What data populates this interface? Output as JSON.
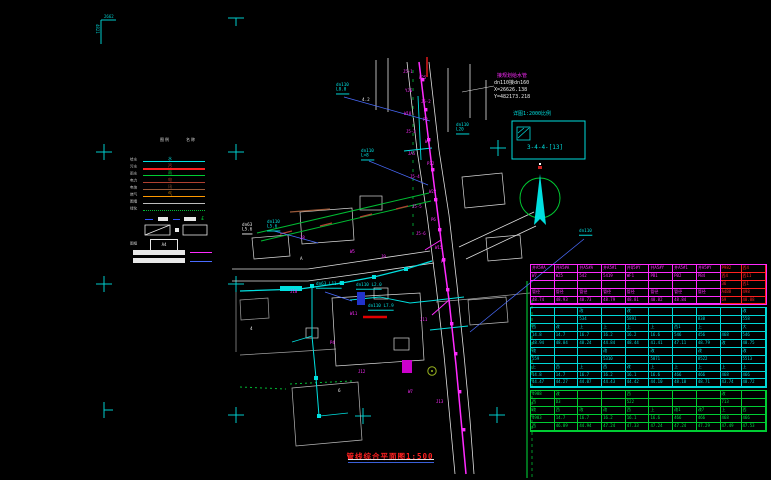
{
  "drawing": {
    "title": "管线综合平面图1:500",
    "corner_note_h": "2662",
    "corner_note_v": "4821",
    "north_mark": "北"
  },
  "colors": {
    "cyan": "#00e0e0",
    "magenta": "#ff2bff",
    "green": "#00cc33",
    "red": "#ff2020",
    "blue": "#4a6cff",
    "white": "#e8e8e8",
    "darkred": "#b04030",
    "brown": "#9a5a3a",
    "orange": "#ff9900",
    "gray": "#bdbdbd"
  },
  "detail_note": {
    "line_magenta": "接规划给水管",
    "line1": "dn110接dn160",
    "line2": "X=26626.138",
    "line3": "Y=482173.218",
    "box_caption": "详图1:2000比例",
    "box_label": "3-4-4-[13]"
  },
  "legend": {
    "headers": [
      "图例",
      "名称"
    ],
    "rows": [
      {
        "label": "给水",
        "color": "#00e0e0",
        "weight": 1.2,
        "style": "solid",
        "mark": "水",
        "markcolor": "#00e0e0"
      },
      {
        "label": "污水",
        "color": "#ff2020",
        "weight": 2,
        "style": "solid",
        "mark": "污",
        "markcolor": "#ff4040"
      },
      {
        "label": "雨水",
        "color": "#00cc33",
        "weight": 1.2,
        "style": "solid",
        "mark": "雨",
        "markcolor": "#00cc33"
      },
      {
        "label": "电力",
        "color": "#b04030",
        "weight": 1,
        "style": "solid",
        "mark": "电",
        "markcolor": "#b04030"
      },
      {
        "label": "电信",
        "color": "#9a5a3a",
        "weight": 1,
        "style": "solid",
        "mark": "讯",
        "markcolor": "#9a5a3a"
      },
      {
        "label": "燃气",
        "color": "#ff9900",
        "weight": 1,
        "style": "solid",
        "mark": "气",
        "markcolor": "#ff9900"
      },
      {
        "label": "围墙",
        "color": "#bdbdbd",
        "weight": 1,
        "style": "solid",
        "mark": "",
        "markcolor": "#bdbdbd"
      },
      {
        "label": "绿化",
        "color": "#00bb33",
        "weight": 1.2,
        "style": "dotted",
        "mark": "",
        "markcolor": "#00bb33"
      }
    ],
    "frame_label": "图框",
    "frame_value": "A4",
    "bar1_tag": "道路",
    "bar2_tag": "规划"
  },
  "map": {
    "labels": [
      {
        "x": 336,
        "y": 84,
        "text": "dn110\nL8.0",
        "color": "#00e0e0",
        "ul": true
      },
      {
        "x": 456,
        "y": 124,
        "text": "dn110\nL20",
        "color": "#00e0e0",
        "ul": true
      },
      {
        "x": 361,
        "y": 150,
        "text": "dn110\nL=8",
        "color": "#00e0e0",
        "ul": true
      },
      {
        "x": 267,
        "y": 221,
        "text": "dn110\nL5.6",
        "color": "#00e0e0",
        "ul": true
      },
      {
        "x": 242,
        "y": 224,
        "text": "dn63\nL5.6",
        "color": "#e8e8e8",
        "ul": true
      },
      {
        "x": 316,
        "y": 283,
        "text": "dn63 L11.5",
        "color": "#00e0e0",
        "ul": true
      },
      {
        "x": 356,
        "y": 284,
        "text": "dn110 L2.0",
        "color": "#00e0e0",
        "ul": true
      },
      {
        "x": 368,
        "y": 305,
        "text": "dn110 L7.9",
        "color": "#00e0e0",
        "ul": true
      },
      {
        "x": 579,
        "y": 230,
        "text": "dn110",
        "color": "#00e0e0",
        "ul": true
      },
      {
        "x": 362,
        "y": 99,
        "text": "4.2",
        "color": "#e8e8e8",
        "ul": false
      },
      {
        "x": 300,
        "y": 258,
        "text": "A",
        "color": "#e8e8e8",
        "ul": false
      },
      {
        "x": 338,
        "y": 390,
        "text": "6",
        "color": "#e8e8e8",
        "ul": false
      },
      {
        "x": 250,
        "y": 328,
        "text": "4",
        "color": "#e8e8e8",
        "ul": false
      }
    ],
    "blobs": [
      {
        "x": 403,
        "y": 70,
        "text": "J5-1"
      },
      {
        "x": 419,
        "y": 76,
        "text": "W25"
      },
      {
        "x": 405,
        "y": 89,
        "text": "YJ6"
      },
      {
        "x": 421,
        "y": 100,
        "text": "J5-2"
      },
      {
        "x": 404,
        "y": 112,
        "text": "W18"
      },
      {
        "x": 423,
        "y": 118,
        "text": "P8"
      },
      {
        "x": 406,
        "y": 130,
        "text": "J5-3"
      },
      {
        "x": 425,
        "y": 140,
        "text": "W9"
      },
      {
        "x": 408,
        "y": 152,
        "text": "JA5"
      },
      {
        "x": 427,
        "y": 162,
        "text": "P12"
      },
      {
        "x": 410,
        "y": 175,
        "text": "J5-4"
      },
      {
        "x": 429,
        "y": 190,
        "text": "W22"
      },
      {
        "x": 412,
        "y": 205,
        "text": "J5-5"
      },
      {
        "x": 431,
        "y": 218,
        "text": "P6"
      },
      {
        "x": 416,
        "y": 232,
        "text": "J5-6"
      },
      {
        "x": 435,
        "y": 246,
        "text": "W15"
      },
      {
        "x": 300,
        "y": 236,
        "text": "J8"
      },
      {
        "x": 350,
        "y": 250,
        "text": "W5"
      },
      {
        "x": 381,
        "y": 255,
        "text": "J9"
      },
      {
        "x": 441,
        "y": 260,
        "text": "P7"
      },
      {
        "x": 290,
        "y": 290,
        "text": "J10"
      },
      {
        "x": 350,
        "y": 312,
        "text": "W11"
      },
      {
        "x": 420,
        "y": 318,
        "text": "J11"
      },
      {
        "x": 330,
        "y": 341,
        "text": "P4"
      },
      {
        "x": 358,
        "y": 370,
        "text": "J12"
      },
      {
        "x": 408,
        "y": 390,
        "text": "W7"
      },
      {
        "x": 436,
        "y": 400,
        "text": "J13"
      }
    ]
  },
  "table": {
    "sections": [
      {
        "name": "proposed",
        "border": "#ff2bff",
        "text": "#ff2bff",
        "red_cols_from": 8,
        "red": "#ff2020",
        "rows": [
          [
            "井A5#A",
            "井A5#A",
            "井A5#A",
            "井A5#1",
            "井Q5#Y",
            "井A5#Y",
            "井A5#1",
            "井A5#Y",
            "P982",
            "西4"
          ],
          [
            "W7",
            "W25",
            "542",
            "5419",
            "WF1",
            "PB1",
            "PB2",
            "PB4",
            "西4",
            "西11"
          ],
          [
            "",
            "",
            "",
            "",
            "",
            "",
            "",
            "",
            "36",
            "西1"
          ],
          [
            "管径",
            "管径",
            "管径",
            "管径",
            "管径",
            "管径",
            "管径",
            "管径",
            "A4B8",
            "498"
          ],
          [
            "48.74",
            "48.93",
            "48.73",
            "48.79",
            "48.81",
            "48.82",
            "48.84",
            "",
            "69",
            "48.88"
          ]
        ]
      },
      {
        "name": "existing",
        "border": "#00d8d8",
        "text": "#00d8d8",
        "red_cols_from": 99,
        "red": "#ff2020",
        "rows": [
          [
            "",
            "",
            "改",
            "",
            "改",
            "",
            "",
            "",
            "",
            "改"
          ],
          [
            "",
            "",
            "534",
            "",
            "5891",
            "",
            "",
            "838",
            "",
            "558"
          ],
          [
            "西",
            "改",
            "上",
            "上",
            "上",
            "上",
            "西1",
            "上",
            "",
            "大"
          ],
          [
            "14.8",
            "14.7",
            "16.7",
            "16.2",
            "16.2",
            "16.6",
            "546",
            "456",
            "468",
            "546"
          ],
          [
            "48.94",
            "48.84",
            "48.24",
            "44.84",
            "48.44",
            "41.41",
            "47.11",
            "48.79",
            "改",
            "48.75"
          ],
          [
            "改",
            "",
            "",
            "改",
            "",
            "改",
            "",
            "改",
            "",
            "改"
          ],
          [
            "559",
            "",
            "",
            "5310",
            "",
            "5871",
            "",
            "8522",
            "",
            "5513"
          ],
          [
            "上",
            "西",
            "上",
            "西",
            "改",
            "上",
            "上",
            "上",
            "上",
            "上"
          ],
          [
            "14.8",
            "14.7",
            "16.7",
            "16.2",
            "16.1",
            "16.6",
            "466",
            "466",
            "468",
            "466"
          ],
          [
            "44.47",
            "44.27",
            "44.07",
            "44.43",
            "44.42",
            "44.10",
            "48.10",
            "48.71",
            "43.74",
            "48.72"
          ]
        ]
      },
      {
        "name": "ground",
        "border": "#00cc33",
        "text": "#00dd44",
        "red_cols_from": 99,
        "red": "#ff2020",
        "rows": [
          [
            "4988",
            "改",
            "",
            "",
            "西",
            "",
            "",
            "",
            "改",
            ""
          ],
          [
            "西",
            "D3",
            "",
            "",
            "522",
            "",
            "",
            "",
            "713",
            ""
          ],
          [
            "改",
            "西",
            "改",
            "改",
            "西",
            "上",
            "改1",
            "改7",
            "上",
            "西"
          ],
          [
            "4983",
            "14.7",
            "16.7",
            "16.2",
            "16.1",
            "16.6",
            "466",
            "466",
            "468",
            "466"
          ],
          [
            "西",
            "46.89",
            "44.94",
            "47.24",
            "47.33",
            "47.24",
            "47.24",
            "47.29",
            "47.49",
            "47.53"
          ]
        ]
      }
    ]
  }
}
